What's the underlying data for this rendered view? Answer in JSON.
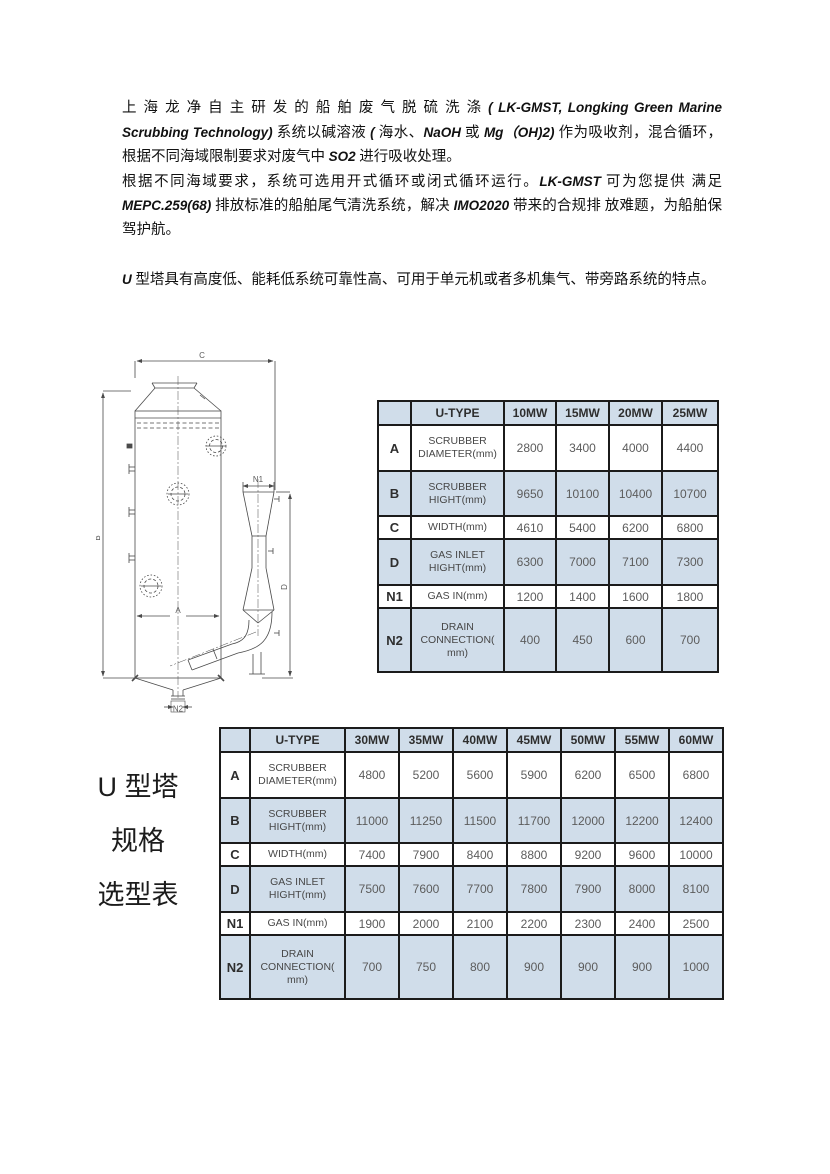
{
  "intro": {
    "paragraphs": [
      {
        "gap_before": false,
        "runs": [
          {
            "text": "上 海 龙 净 自 主 研 发 的 船 舶 废 气 脱 硫 洗 涤 ",
            "italic": false
          },
          {
            "text": "( LK-GMST, Longking Green Marine Scrubbing Technology) ",
            "italic": true
          },
          {
            "text": "系统以碱溶液 ",
            "italic": false
          },
          {
            "text": "( ",
            "italic": true
          },
          {
            "text": "海水、",
            "italic": false
          },
          {
            "text": "NaOH",
            "italic": true
          },
          {
            "text": " 或 ",
            "italic": false
          },
          {
            "text": "Mg（OH)2) ",
            "italic": true
          },
          {
            "text": "作为吸收剂，混合循环，根据不同海域限制要求对废气中 ",
            "italic": false
          },
          {
            "text": "SO2",
            "italic": true
          },
          {
            "text": " 进行吸收处理。",
            "italic": false
          }
        ]
      },
      {
        "gap_before": false,
        "runs": [
          {
            "text": "根据不同海域要求，系统可选用开式循环或闭式循环运行。",
            "italic": false
          },
          {
            "text": "LK-GMST",
            "italic": true
          },
          {
            "text": " 可为您提供 满足 ",
            "italic": false
          },
          {
            "text": "MEPC.259(68)",
            "italic": true
          },
          {
            "text": " 排放标准的船舶尾气清洗系统，解决 ",
            "italic": false
          },
          {
            "text": "IMO2020",
            "italic": true
          },
          {
            "text": " 带来的合规排 放难题，为船舶保驾护航。",
            "italic": false
          }
        ]
      },
      {
        "gap_before": true,
        "runs": [
          {
            "text": "U",
            "italic": true
          },
          {
            "text": " 型塔具有高度低、能耗低系统可靠性高、可用于单元机或者多机集气、带旁路系统的特点。",
            "italic": false
          }
        ]
      }
    ]
  },
  "diagram": {
    "labels": {
      "A": "A",
      "B": "B",
      "C": "C",
      "D": "D",
      "N1": "N1",
      "N2": "N2"
    }
  },
  "side_label": {
    "lines": [
      "U 型塔",
      "规格",
      "选型表"
    ]
  },
  "tables": [
    {
      "headers": [
        "",
        "U-TYPE",
        "10MW",
        "15MW",
        "20MW",
        "25MW"
      ],
      "rows": [
        {
          "key": "A",
          "name": "SCRUBBER DIAMETER(mm)",
          "values": [
            "2800",
            "3400",
            "4000",
            "4400"
          ]
        },
        {
          "key": "B",
          "name": "SCRUBBER HIGHT(mm)",
          "values": [
            "9650",
            "10100",
            "10400",
            "10700"
          ]
        },
        {
          "key": "C",
          "name": "WIDTH(mm)",
          "values": [
            "4610",
            "5400",
            "6200",
            "6800"
          ]
        },
        {
          "key": "D",
          "name": "GAS INLET HIGHT(mm)",
          "values": [
            "6300",
            "7000",
            "7100",
            "7300"
          ]
        },
        {
          "key": "N1",
          "name": "GAS IN(mm)",
          "values": [
            "1200",
            "1400",
            "1600",
            "1800"
          ]
        },
        {
          "key": "N2",
          "name": "DRAIN CONNECTION( mm)",
          "values": [
            "400",
            "450",
            "600",
            "700"
          ]
        }
      ]
    },
    {
      "headers": [
        "",
        "U-TYPE",
        "30MW",
        "35MW",
        "40MW",
        "45MW",
        "50MW",
        "55MW",
        "60MW"
      ],
      "rows": [
        {
          "key": "A",
          "name": "SCRUBBER DIAMETER(mm)",
          "values": [
            "4800",
            "5200",
            "5600",
            "5900",
            "6200",
            "6500",
            "6800"
          ]
        },
        {
          "key": "B",
          "name": "SCRUBBER HIGHT(mm)",
          "values": [
            "11000",
            "11250",
            "11500",
            "11700",
            "12000",
            "12200",
            "12400"
          ]
        },
        {
          "key": "C",
          "name": "WIDTH(mm)",
          "values": [
            "7400",
            "7900",
            "8400",
            "8800",
            "9200",
            "9600",
            "10000"
          ]
        },
        {
          "key": "D",
          "name": "GAS INLET HIGHT(mm)",
          "values": [
            "7500",
            "7600",
            "7700",
            "7800",
            "7900",
            "8000",
            "8100"
          ]
        },
        {
          "key": "N1",
          "name": "GAS IN(mm)",
          "values": [
            "1900",
            "2000",
            "2100",
            "2200",
            "2300",
            "2400",
            "2500"
          ]
        },
        {
          "key": "N2",
          "name": "DRAIN CONNECTION( mm)",
          "values": [
            "700",
            "750",
            "800",
            "900",
            "900",
            "900",
            "1000"
          ]
        }
      ]
    }
  ],
  "colors": {
    "table_header_fill": "#d0ddea",
    "table_border": "#1b1b1b",
    "value_text": "#5c5c5c",
    "drawing_line": "#4a4a4a"
  }
}
